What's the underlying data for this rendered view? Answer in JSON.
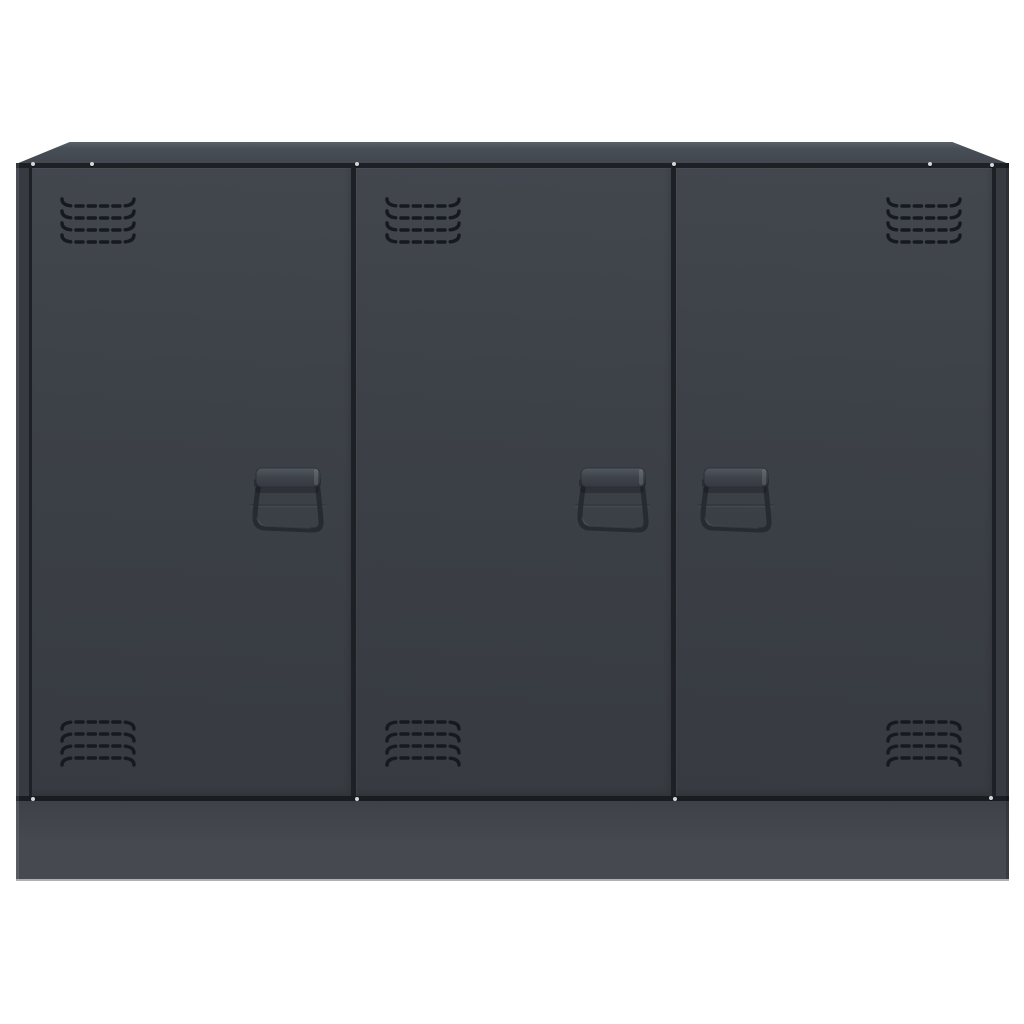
{
  "scene": {
    "kind": "product-photo",
    "subject": "three-door anthracite steel sideboard cabinet on white background",
    "door_count": 3,
    "handle_count": 3,
    "vent_grille_count": 6,
    "vent_rows_per_grille": 4,
    "screw_dot_count": 10
  },
  "colors": {
    "background": "#ffffff",
    "top_face_light": "#5a6067",
    "top_face": "#484e55",
    "top_face_front": "#42474f",
    "door_face_light": "#42474e",
    "door_face": "#3c4147",
    "door_face_dark": "#373b41",
    "frame": "#363a41",
    "seam": "#1d2126",
    "plinth_top": "#3e4248",
    "plinth": "#46494f",
    "plinth_bottom_edge": "#aeb0b3",
    "vent_slot": "#16191d",
    "handle_wire": "#262b31",
    "handle_bar_light": "#525860",
    "handle_bar": "#3e434b",
    "handle_bar_dark": "#343942",
    "screw_dot": "#d5d7d9",
    "edge_highlight": "rgba(255,255,255,0.10)",
    "edge_shadow": "rgba(0,0,0,0.18)"
  }
}
